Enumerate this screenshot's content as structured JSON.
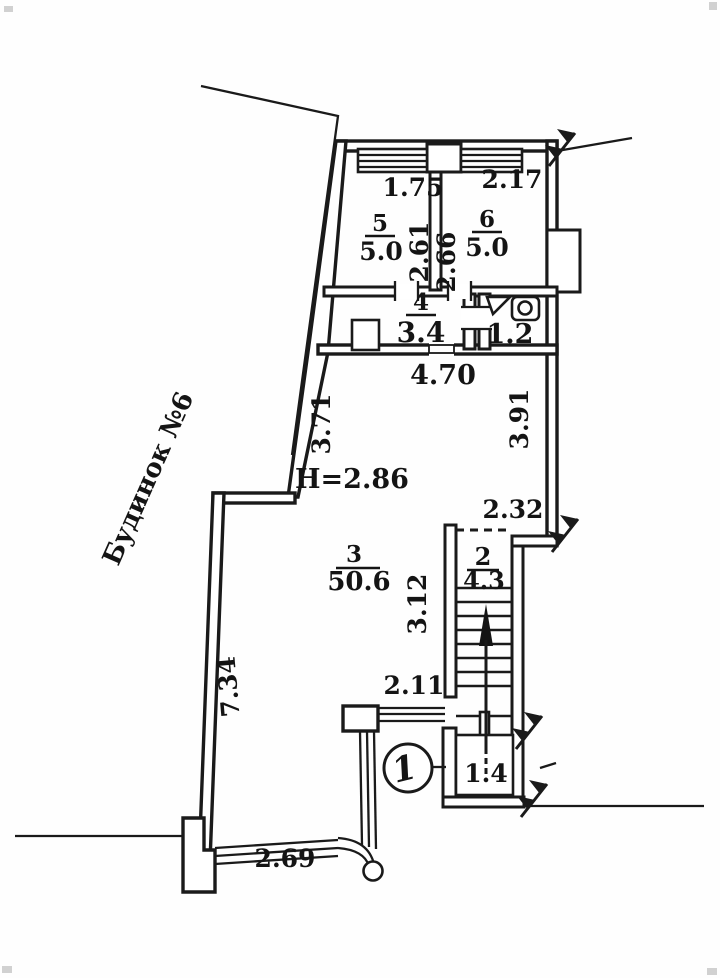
{
  "plan": {
    "neighbor_building_label": "Будинок №6",
    "ceiling_height_label": "H=2.86",
    "entrance_node_label": "1",
    "rooms": [
      {
        "number": "5",
        "area": "5.0",
        "width": "1.75",
        "depth": "2.61"
      },
      {
        "number": "6",
        "area": "5.0",
        "width": "2.17",
        "depth": "2.66"
      },
      {
        "number": "4",
        "area": "3.4"
      },
      {
        "number": "3",
        "area": "50.6"
      },
      {
        "number": "2",
        "area": "4.3"
      }
    ],
    "wc_area": "1.2",
    "vestibule_area": "1.4",
    "dims": {
      "hall_top": "4.70",
      "left_upper": "3.71",
      "right_upper": "3.91",
      "nook": "2.32",
      "stair_side": "3.12",
      "porch": "2.11",
      "left_lower": "7.34",
      "railing": "2.69"
    }
  }
}
